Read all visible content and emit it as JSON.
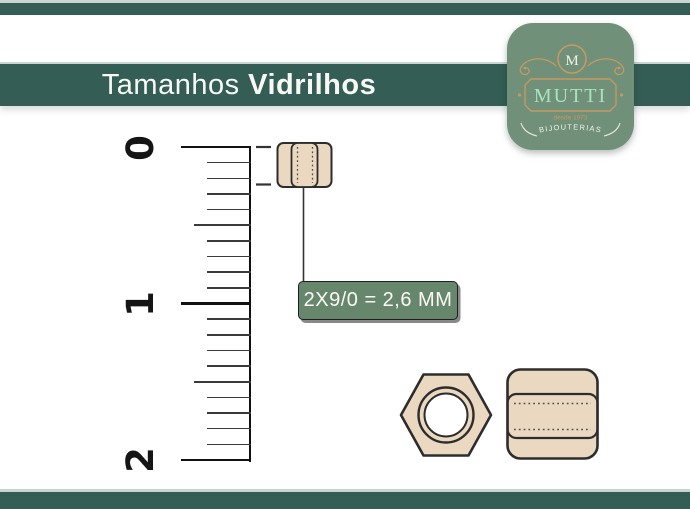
{
  "header": {
    "title_light": "Tamanhos",
    "title_bold": "Vidrilhos"
  },
  "logo": {
    "monogram": "M",
    "brand": "MUTTI",
    "since": "desde 1973",
    "tagline": "BIJOUTERIAS"
  },
  "ruler": {
    "numbers": [
      "0",
      "1",
      "2"
    ]
  },
  "measurement": {
    "label": "2X9/0 = 2,6 MM"
  },
  "colors": {
    "teal_band": "#335d55",
    "logo_green": "#70907a",
    "label_green": "#67876c",
    "bead_tan": "#ead9c0",
    "outline_dark": "#2d2d2d",
    "gold": "#c49a5f",
    "mint": "#a9e3bd",
    "hairline": "#c9d6cf"
  }
}
